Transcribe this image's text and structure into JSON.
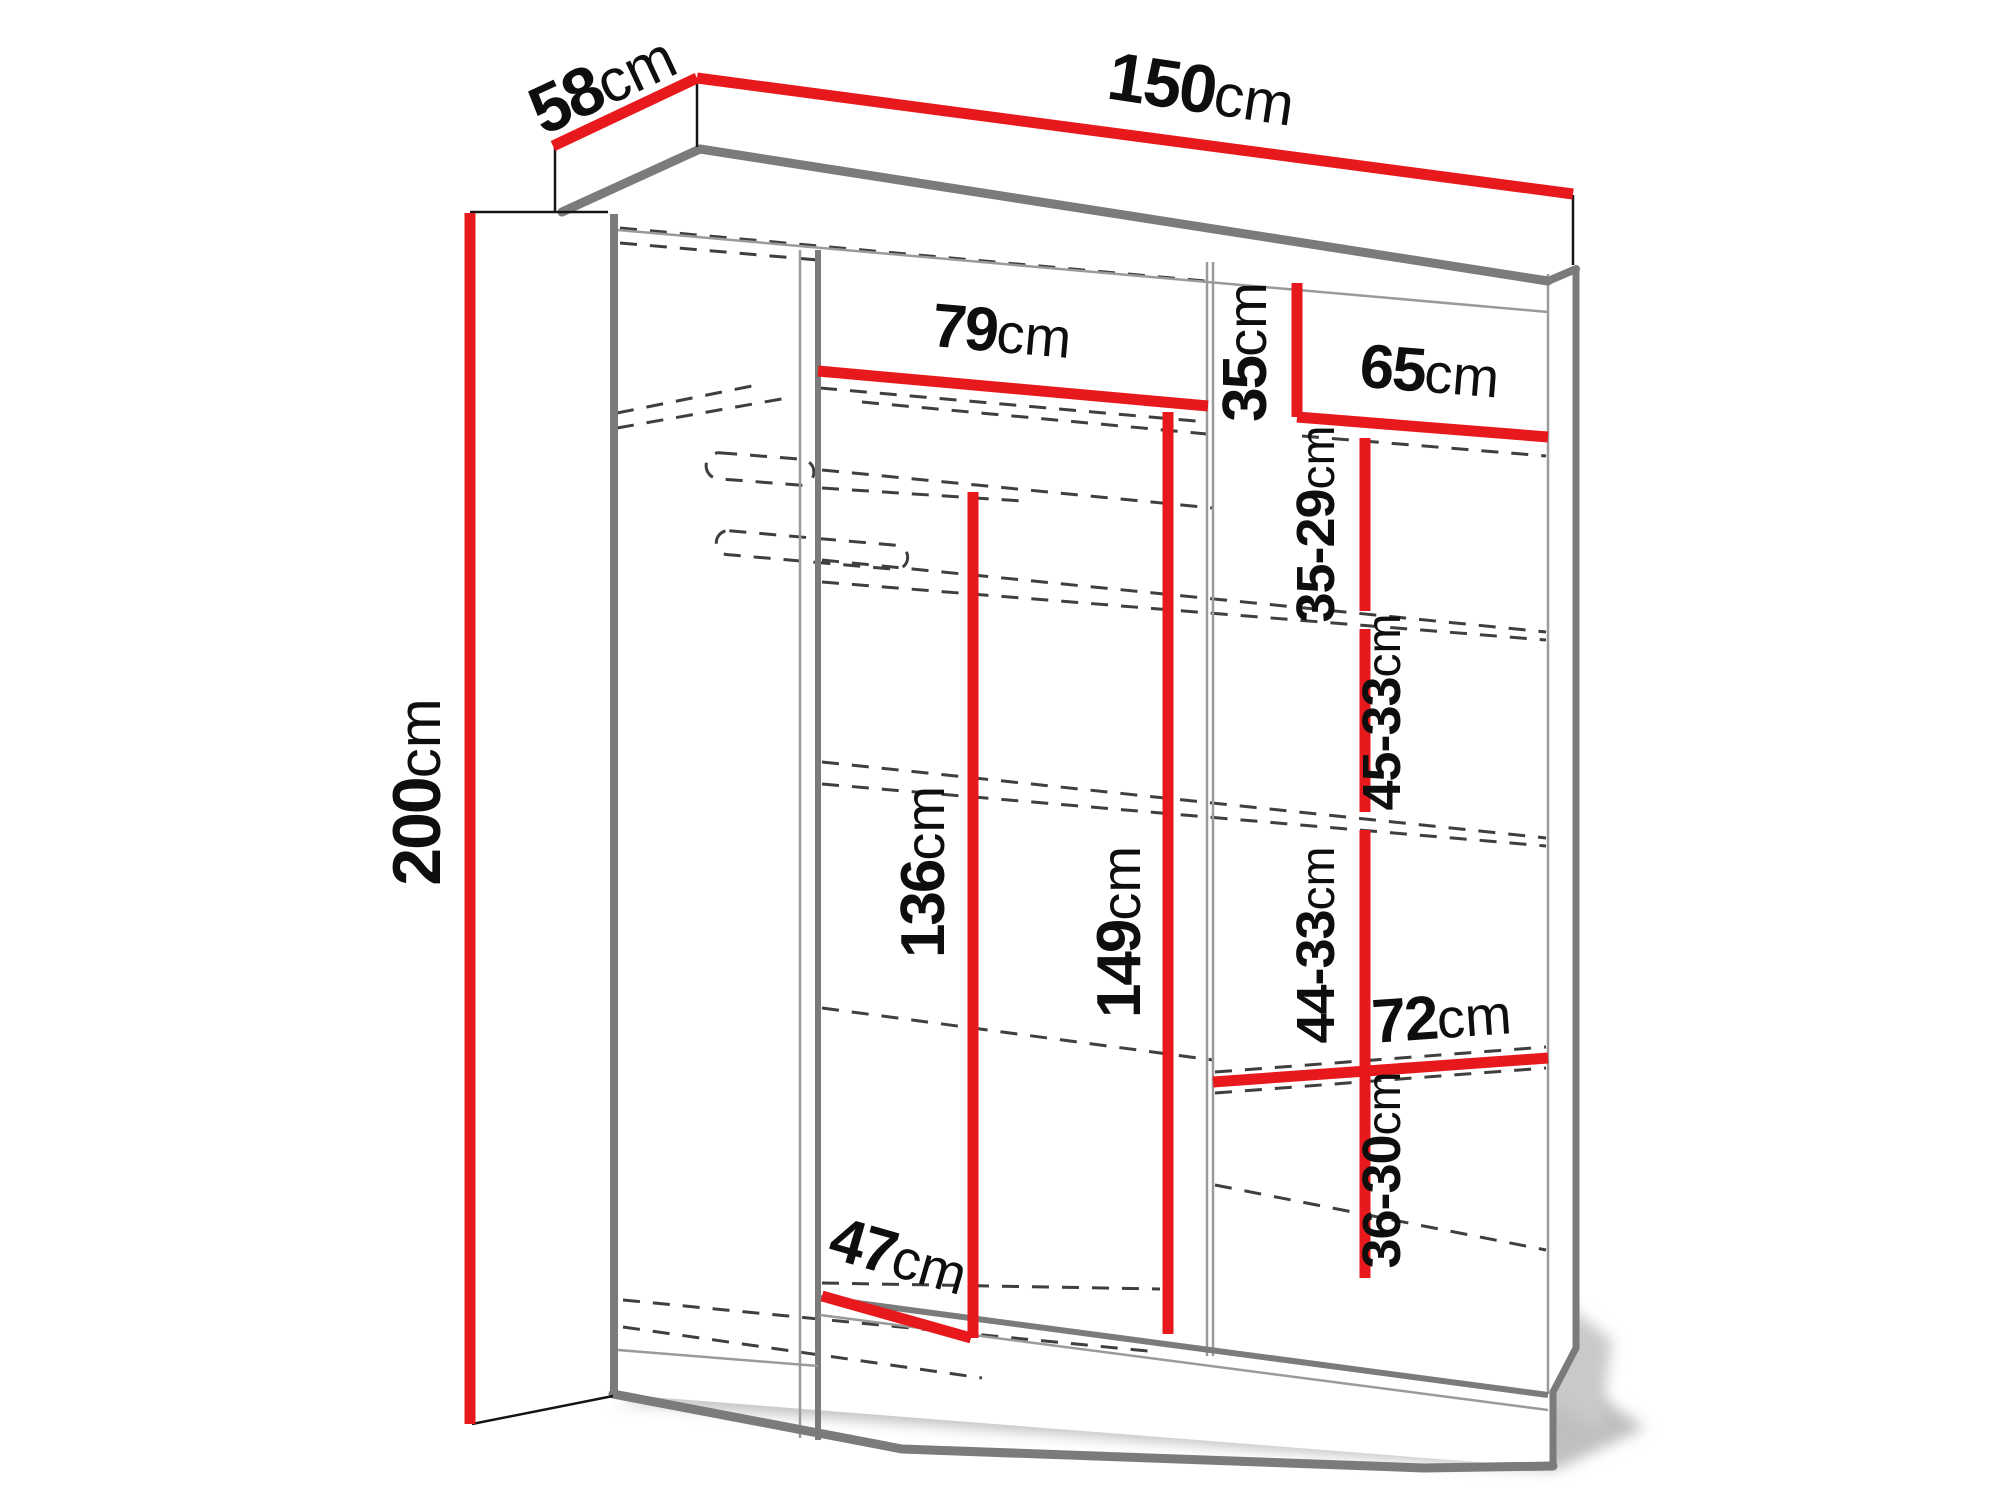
{
  "title": "Wardrobe dimension diagram",
  "unit": "cm",
  "colors": {
    "dimension_line": "#e8191c",
    "structure_edge": "#7b7b7b",
    "hidden_edge": "#3f3f3f",
    "label_text": "#0e0e0e",
    "background": "#ffffff"
  },
  "dimensions": {
    "height": {
      "value": "200",
      "unit": "cm"
    },
    "depth": {
      "value": "58",
      "unit": "cm"
    },
    "width": {
      "value": "150",
      "unit": "cm"
    },
    "top_shelf_width": {
      "value": "79",
      "unit": "cm"
    },
    "top_right_height": {
      "value": "35",
      "unit": "cm"
    },
    "right_shelf_width": {
      "value": "65",
      "unit": "cm"
    },
    "shelf_gap_1": {
      "value": "35-29",
      "unit": "cm"
    },
    "shelf_gap_2": {
      "value": "45-33",
      "unit": "cm"
    },
    "shelf_gap_3": {
      "value": "44-33",
      "unit": "cm"
    },
    "shelf_gap_4": {
      "value": "36-30",
      "unit": "cm"
    },
    "bottom_right_width": {
      "value": "72",
      "unit": "cm"
    },
    "hanging_height": {
      "value": "136",
      "unit": "cm"
    },
    "interior_height": {
      "value": "149",
      "unit": "cm"
    },
    "bottom_depth": {
      "value": "47",
      "unit": "cm"
    }
  }
}
